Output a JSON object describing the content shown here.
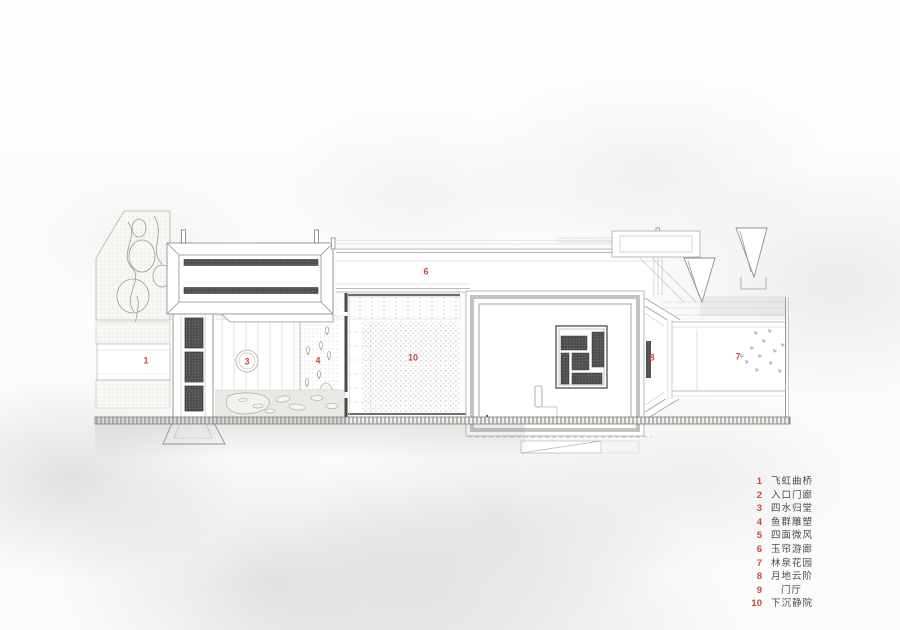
{
  "plan": {
    "area_labels": {
      "n1": "1",
      "n3": "3",
      "n4": "4",
      "n6": "6",
      "n7": "7",
      "n8": "8",
      "n10": "10"
    }
  },
  "legend": {
    "items": [
      {
        "num": "1",
        "label": "飞虹曲桥"
      },
      {
        "num": "2",
        "label": "入口门廊"
      },
      {
        "num": "3",
        "label": "四水归堂"
      },
      {
        "num": "4",
        "label": "鱼群雕塑"
      },
      {
        "num": "5",
        "label": "四面微风"
      },
      {
        "num": "6",
        "label": "玉帘游廊"
      },
      {
        "num": "7",
        "label": "林泉花园"
      },
      {
        "num": "8",
        "label": "月地云阶"
      },
      {
        "num": "9",
        "label": "门厅"
      },
      {
        "num": "10",
        "label": "下沉静院"
      }
    ]
  },
  "colors": {
    "accent_red": "#cc4840",
    "line_gray": "#9a9a97",
    "dark_hatch": "#4c4c4c"
  }
}
